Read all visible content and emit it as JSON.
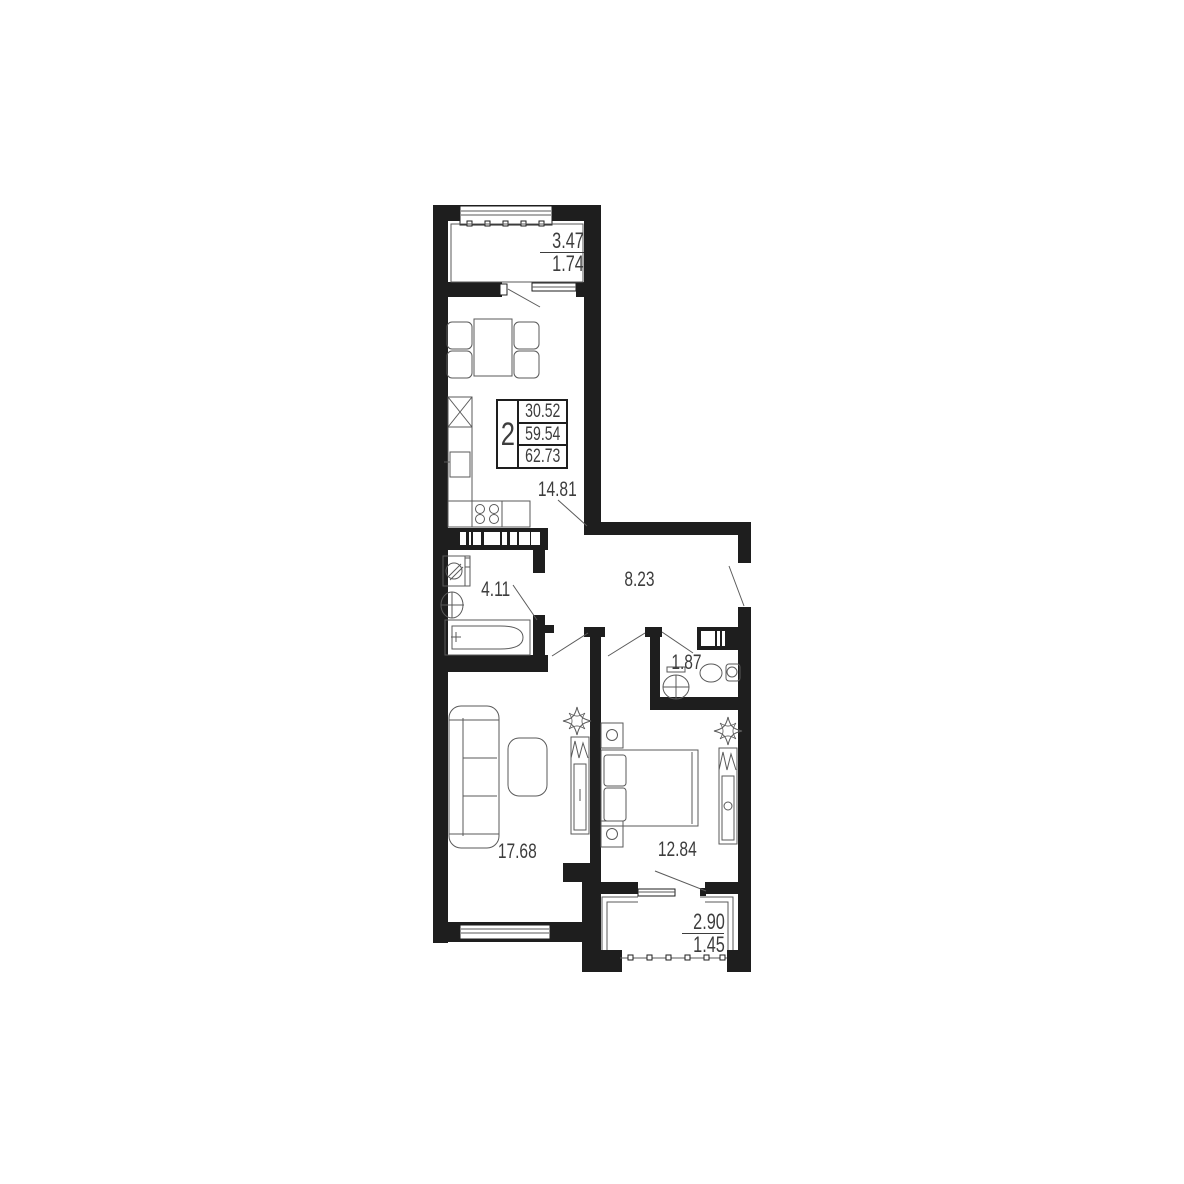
{
  "plan": {
    "summary": {
      "rooms_count": "2",
      "area_living": "30.52",
      "area_apartment": "59.54",
      "area_total": "62.73"
    },
    "rooms": {
      "kitchen": "14.81",
      "hall": "8.23",
      "bathroom": "4.11",
      "wc": "1.87",
      "living_room": "17.68",
      "bedroom": "12.84",
      "balcony_top": {
        "full": "3.47",
        "counted": "1.74"
      },
      "balcony_bottom": {
        "full": "2.90",
        "counted": "1.45"
      }
    },
    "colors": {
      "wall": "#1e1e1e",
      "line": "#5a5a5a",
      "text": "#3d3d3d",
      "background": "#ffffff"
    }
  }
}
